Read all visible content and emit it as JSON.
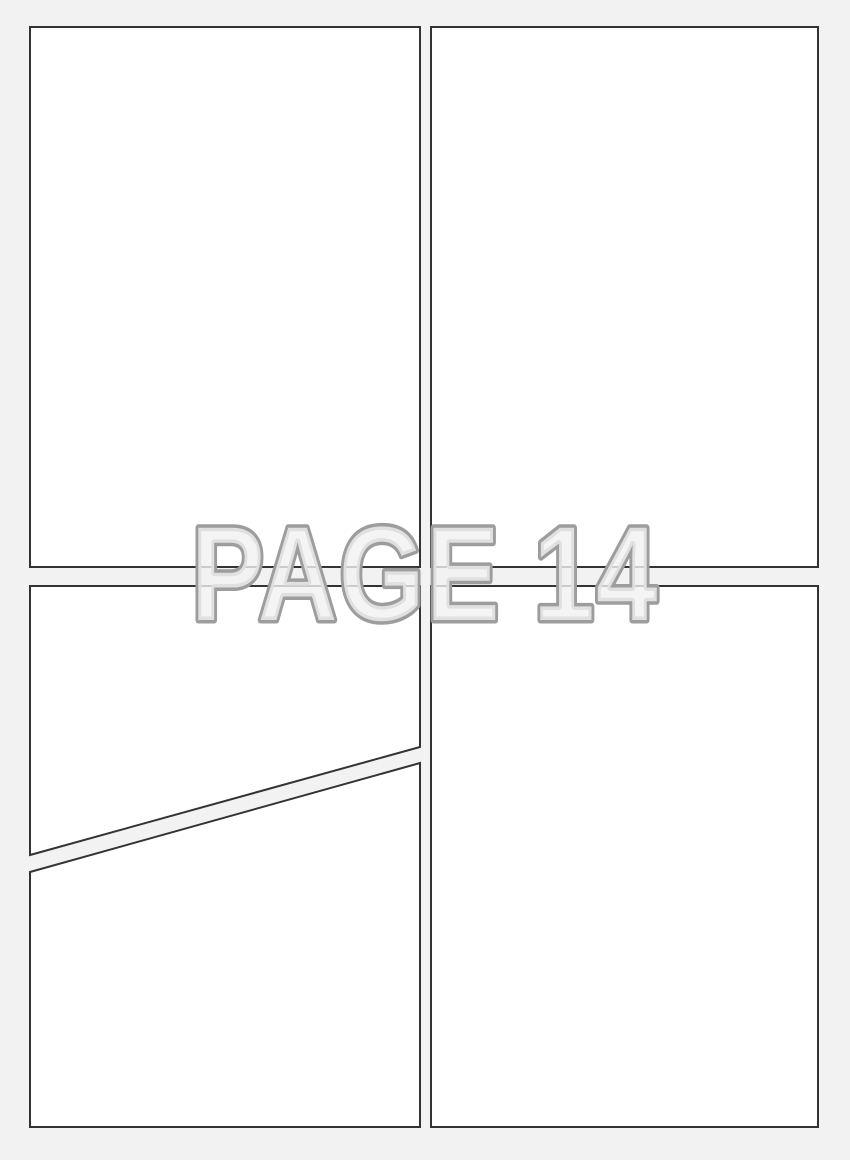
{
  "page": {
    "label": "PAGE 14"
  },
  "panels": [
    {
      "name": "panel-top-left"
    },
    {
      "name": "panel-top-right"
    },
    {
      "name": "panel-bottom-left-upper"
    },
    {
      "name": "panel-bottom-left-lower"
    },
    {
      "name": "panel-bottom-right"
    }
  ],
  "colors": {
    "page_background": "#f2f2f2",
    "panel_fill": "#ffffff",
    "panel_border": "#333333",
    "label_outline": "#9d9d9d",
    "label_fill": "#f1f1f1"
  }
}
